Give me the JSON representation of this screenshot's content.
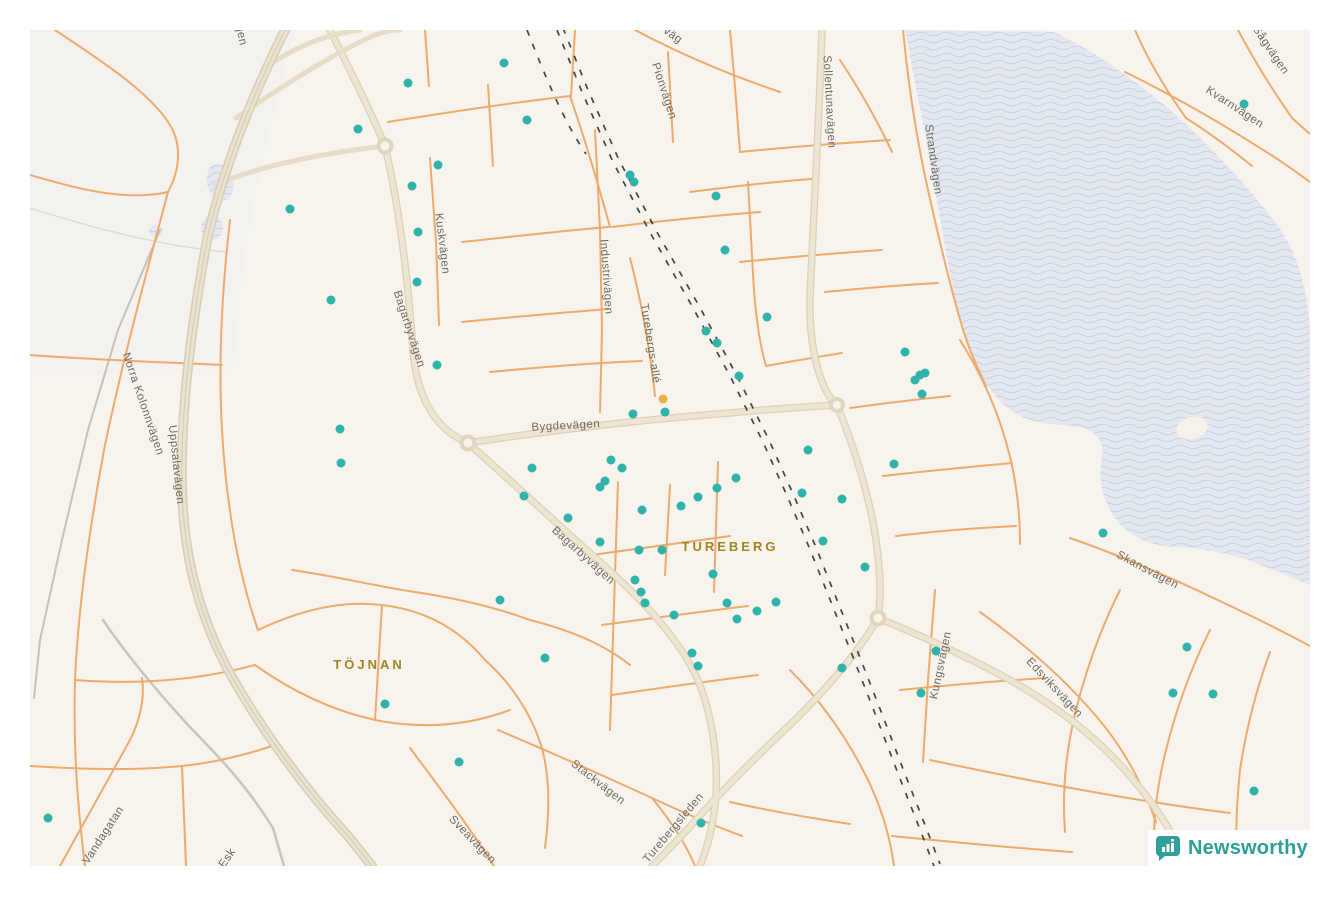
{
  "attribution": {
    "brand": "Newsworthy"
  },
  "map": {
    "colors": {
      "background": "#f8f4ed",
      "dot": "#2fb3aa",
      "dot_highlight": "#e9b13e",
      "road_minor": "#ecaa6c",
      "road_major_fill": "#ece5d2",
      "road_major_edge": "#dbd2b8",
      "water": "#e3e8f0",
      "water_wave": "#c9d2e0",
      "railway": "#46453f",
      "road_label": "#6f6a60",
      "area_label": "#a1861f",
      "brand_teal": "#2d9f98"
    },
    "area_labels": [
      {
        "text": "TUREBERG",
        "x": 700,
        "y": 521,
        "rot": 0
      },
      {
        "text": "TÖJNAN",
        "x": 339,
        "y": 639,
        "rot": 0
      }
    ],
    "road_labels": [
      {
        "text": "Bygdevägen",
        "x": 536,
        "y": 399,
        "rot": -3
      },
      {
        "text": "Bagarbyvägen",
        "x": 376,
        "y": 300,
        "rot": 72
      },
      {
        "text": "Bagarbyvägen",
        "x": 551,
        "y": 528,
        "rot": 42
      },
      {
        "text": "Uppsalavägen",
        "x": 143,
        "y": 435,
        "rot": 84
      },
      {
        "text": "Norra Kolonnvägen",
        "x": 110,
        "y": 375,
        "rot": 71
      },
      {
        "text": "Sollentunavägen",
        "x": 796,
        "y": 72,
        "rot": 87
      },
      {
        "text": "Strandvägen",
        "x": 900,
        "y": 130,
        "rot": 82
      },
      {
        "text": "Kvarnvägen",
        "x": 1203,
        "y": 80,
        "rot": 33
      },
      {
        "text": "Sågvägen",
        "x": 1238,
        "y": 22,
        "rot": 56
      },
      {
        "text": "Pionvägen",
        "x": 631,
        "y": 62,
        "rot": 72
      },
      {
        "text": "väg",
        "x": 641,
        "y": 8,
        "rot": 35
      },
      {
        "text": "gen",
        "x": 208,
        "y": 6,
        "rot": 78
      },
      {
        "text": "Industrivägen",
        "x": 573,
        "y": 247,
        "rot": 86
      },
      {
        "text": "Turebergs-allé",
        "x": 617,
        "y": 314,
        "rot": 81
      },
      {
        "text": "Kuskvägen",
        "x": 409,
        "y": 214,
        "rot": 83
      },
      {
        "text": "Stackvägen",
        "x": 566,
        "y": 755,
        "rot": 38
      },
      {
        "text": "Sveavägen",
        "x": 440,
        "y": 812,
        "rot": 46
      },
      {
        "text": "Turebergsleden",
        "x": 646,
        "y": 800,
        "rot": -50
      },
      {
        "text": "Vandagatan",
        "x": 76,
        "y": 807,
        "rot": -57
      },
      {
        "text": "Esk",
        "x": 200,
        "y": 830,
        "rot": -55
      },
      {
        "text": "Kungsvägen",
        "x": 914,
        "y": 636,
        "rot": -78
      },
      {
        "text": "Edsviksvägen",
        "x": 1022,
        "y": 660,
        "rot": 47
      },
      {
        "text": "Skansvägen",
        "x": 1116,
        "y": 543,
        "rot": 28
      }
    ],
    "dots": {
      "teal": [
        [
          378,
          53
        ],
        [
          474,
          33
        ],
        [
          328,
          99
        ],
        [
          497,
          90
        ],
        [
          408,
          135
        ],
        [
          382,
          156
        ],
        [
          260,
          179
        ],
        [
          388,
          202
        ],
        [
          387,
          252
        ],
        [
          301,
          270
        ],
        [
          407,
          335
        ],
        [
          600,
          145
        ],
        [
          604,
          152
        ],
        [
          686,
          166
        ],
        [
          695,
          220
        ],
        [
          310,
          399
        ],
        [
          311,
          433
        ],
        [
          603,
          384
        ],
        [
          635,
          382
        ],
        [
          581,
          430
        ],
        [
          592,
          438
        ],
        [
          570,
          457
        ],
        [
          575,
          451
        ],
        [
          612,
          480
        ],
        [
          651,
          476
        ],
        [
          668,
          467
        ],
        [
          687,
          458
        ],
        [
          706,
          448
        ],
        [
          778,
          420
        ],
        [
          772,
          463
        ],
        [
          812,
          469
        ],
        [
          793,
          511
        ],
        [
          570,
          512
        ],
        [
          609,
          520
        ],
        [
          632,
          520
        ],
        [
          683,
          544
        ],
        [
          875,
          322
        ],
        [
          885,
          350
        ],
        [
          890,
          345
        ],
        [
          895,
          343
        ],
        [
          892,
          364
        ],
        [
          864,
          434
        ],
        [
          835,
          537
        ],
        [
          605,
          550
        ],
        [
          611,
          562
        ],
        [
          615,
          573
        ],
        [
          644,
          585
        ],
        [
          697,
          573
        ],
        [
          707,
          589
        ],
        [
          727,
          581
        ],
        [
          746,
          572
        ],
        [
          662,
          623
        ],
        [
          668,
          636
        ],
        [
          812,
          638
        ],
        [
          906,
          621
        ],
        [
          891,
          663
        ],
        [
          1157,
          617
        ],
        [
          1143,
          663
        ],
        [
          1183,
          664
        ],
        [
          1224,
          761
        ],
        [
          1073,
          503
        ],
        [
          1214,
          74
        ],
        [
          18,
          788
        ],
        [
          355,
          674
        ],
        [
          429,
          732
        ],
        [
          671,
          793
        ],
        [
          676,
          301
        ],
        [
          687,
          313
        ],
        [
          737,
          287
        ],
        [
          709,
          346
        ],
        [
          502,
          438
        ],
        [
          494,
          466
        ],
        [
          538,
          488
        ],
        [
          470,
          570
        ],
        [
          515,
          628
        ]
      ],
      "orange": [
        [
          633,
          369
        ]
      ]
    }
  }
}
